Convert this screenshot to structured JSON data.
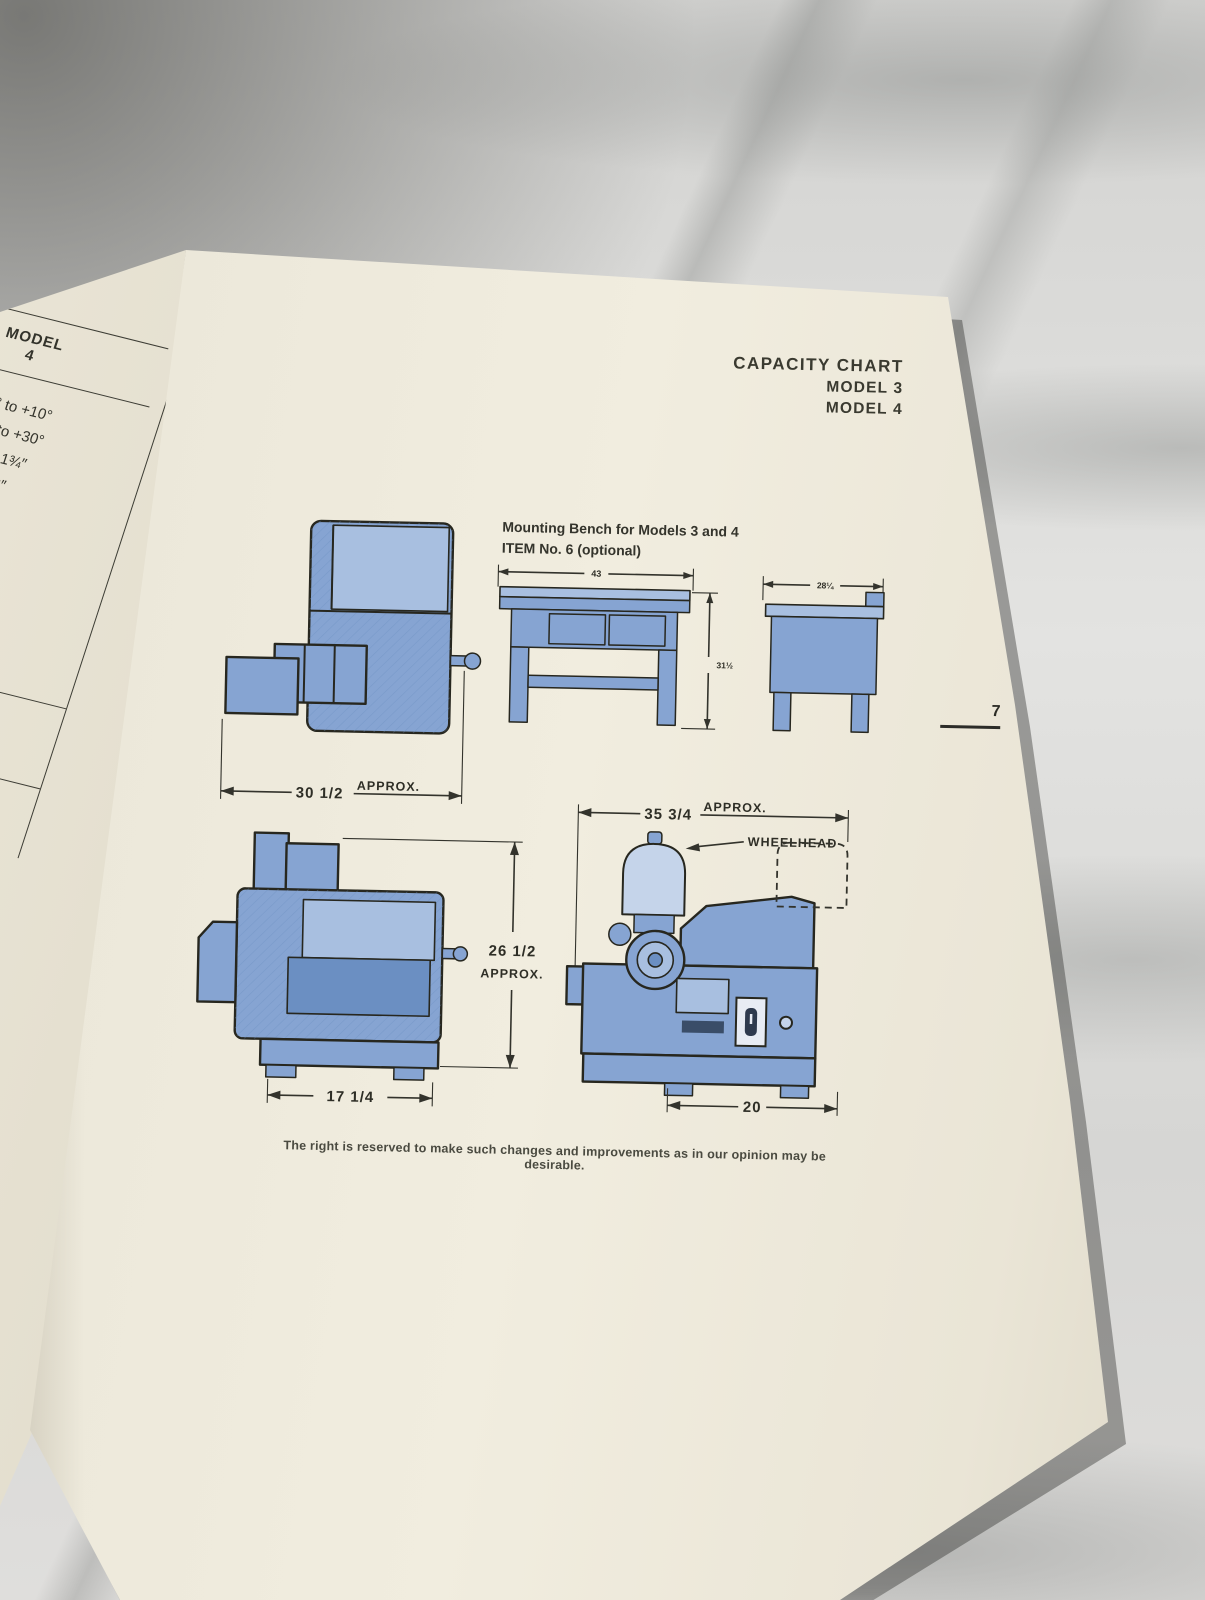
{
  "scene": {
    "description": "printed machine-tool brochure page lying on a marble countertop",
    "colors": {
      "marble-base": "#d8d8d6",
      "marble-vein": "#9a9c9a",
      "page-cream": "#ece8da",
      "machine-blue": "#86a4d2",
      "machine-blue-light": "#a8bfe0",
      "machine-blue-dark": "#6b8fc2",
      "guard-light": "#c5d4ea",
      "ink": "#27271f",
      "text": "#3b3b33"
    }
  },
  "header": {
    "title": "CAPACITY CHART",
    "model_line1": "MODEL 3",
    "model_line2": "MODEL 4"
  },
  "page_number": "7",
  "spec_table": {
    "header_top": "MODEL",
    "header_bottom": "4",
    "rows": [
      "-15° to +10°",
      "-10° to +30°",
      "0″ to 1¾″",
      "5/16″",
      "50°",
      "65°",
      "90°",
      "½″",
      ".050″",
      "rpm",
      "1800 rpm",
      "0″",
      "¾″"
    ]
  },
  "bench": {
    "caption_line1": "Mounting Bench for Models 3 and 4",
    "caption_line2": "ITEM No. 6 (optional)",
    "front_width_dim": "43",
    "front_height_dim": "31½",
    "side_depth_dim": "28¼"
  },
  "machine_front": {
    "width_dim": "30 1/2",
    "approx": "APPROX."
  },
  "machine_side": {
    "height_dim": "26 1/2",
    "height_approx": "APPROX.",
    "width_dim": "17 1/4"
  },
  "wheelhead_view": {
    "width_dim": "35 3/4",
    "approx": "APPROX.",
    "wheelhead_label": "WHEELHEAD",
    "base_width_dim": "20"
  },
  "footer": {
    "disclaimer": "The right is reserved to make such changes and improvements as in our opinion may be desirable."
  }
}
